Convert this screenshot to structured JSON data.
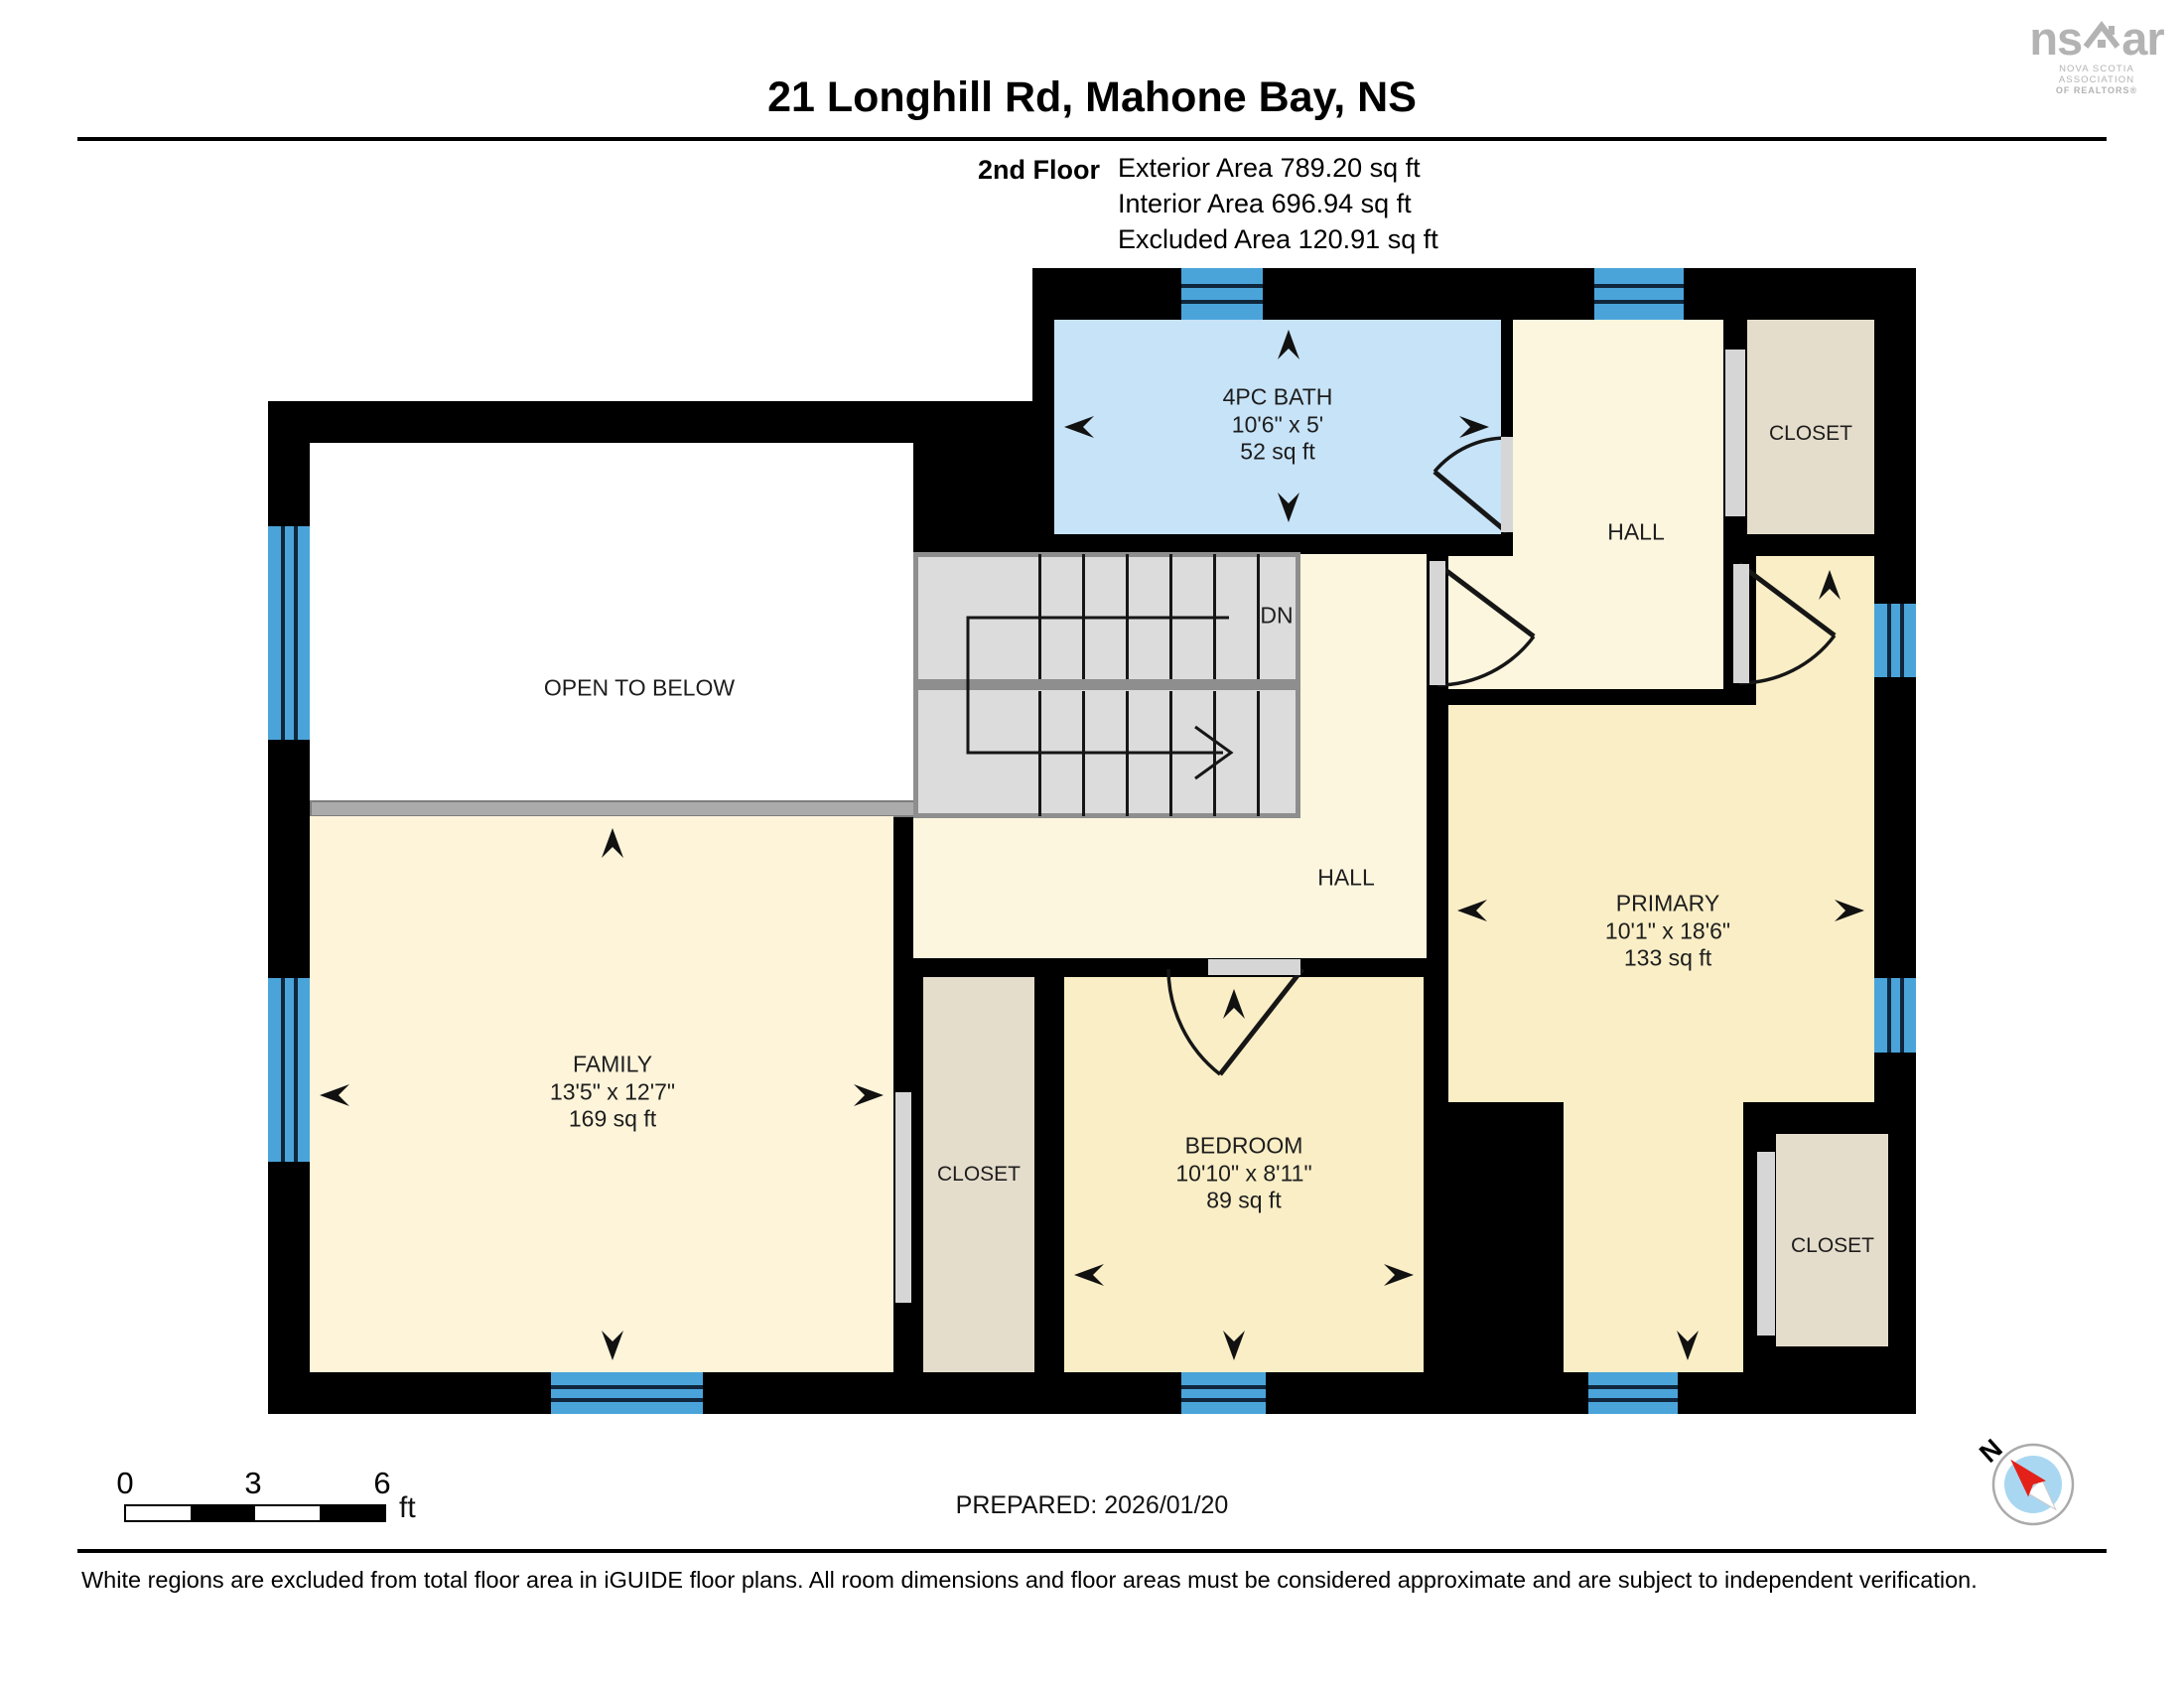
{
  "header": {
    "title": "21 Longhill Rd, Mahone Bay, NS",
    "floor_label": "2nd Floor",
    "exterior_area": "Exterior Area 789.20 sq ft",
    "interior_area": "Interior Area 696.94 sq ft",
    "excluded_area": "Excluded Area 120.91 sq ft"
  },
  "logo": {
    "word_left": "ns",
    "word_right": "ar",
    "sub_line1": "NOVA SCOTIA ASSOCIATION",
    "sub_line2": "OF REALTORS®"
  },
  "rooms": {
    "bath": {
      "name": "4PC BATH",
      "dims": "10'6\" x 5'",
      "area": "52 sq ft"
    },
    "family": {
      "name": "FAMILY",
      "dims": "13'5\" x 12'7\"",
      "area": "169 sq ft"
    },
    "bedroom": {
      "name": "BEDROOM",
      "dims": "10'10\" x 8'11\"",
      "area": "89 sq ft"
    },
    "primary": {
      "name": "PRIMARY",
      "dims": "10'1\" x 18'6\"",
      "area": "133 sq ft"
    },
    "hall_upper": "HALL",
    "hall_lower": "HALL",
    "closet_top": "CLOSET",
    "closet_mid": "CLOSET",
    "closet_bottom": "CLOSET",
    "open_to_below": "OPEN TO BELOW",
    "stairs_down": "DN"
  },
  "scale_bar": {
    "tick0": "0",
    "tick3": "3",
    "tick6": "6",
    "unit": "ft"
  },
  "footer": {
    "prepared": "PREPARED: 2026/01/20",
    "disclaimer": "White regions are excluded from total floor area in iGUIDE floor plans. All room dimensions and floor areas must be considered approximate and are subject to independent verification."
  },
  "compass": {
    "north": "N"
  },
  "colors": {
    "wall": "#000000",
    "hall_cream": "#fdf6df",
    "room_yellow": "#faeec6",
    "bath_blue": "#c7e3f7",
    "window_blue": "#4aa4da",
    "closet_beige": "#e5ddcb",
    "stairs_gray": "#dcdcdc",
    "railing_gray": "#ababab",
    "door_gray": "#d6d6d6",
    "logo_gray": "#b3b3b3",
    "compass_red": "#e32119"
  }
}
